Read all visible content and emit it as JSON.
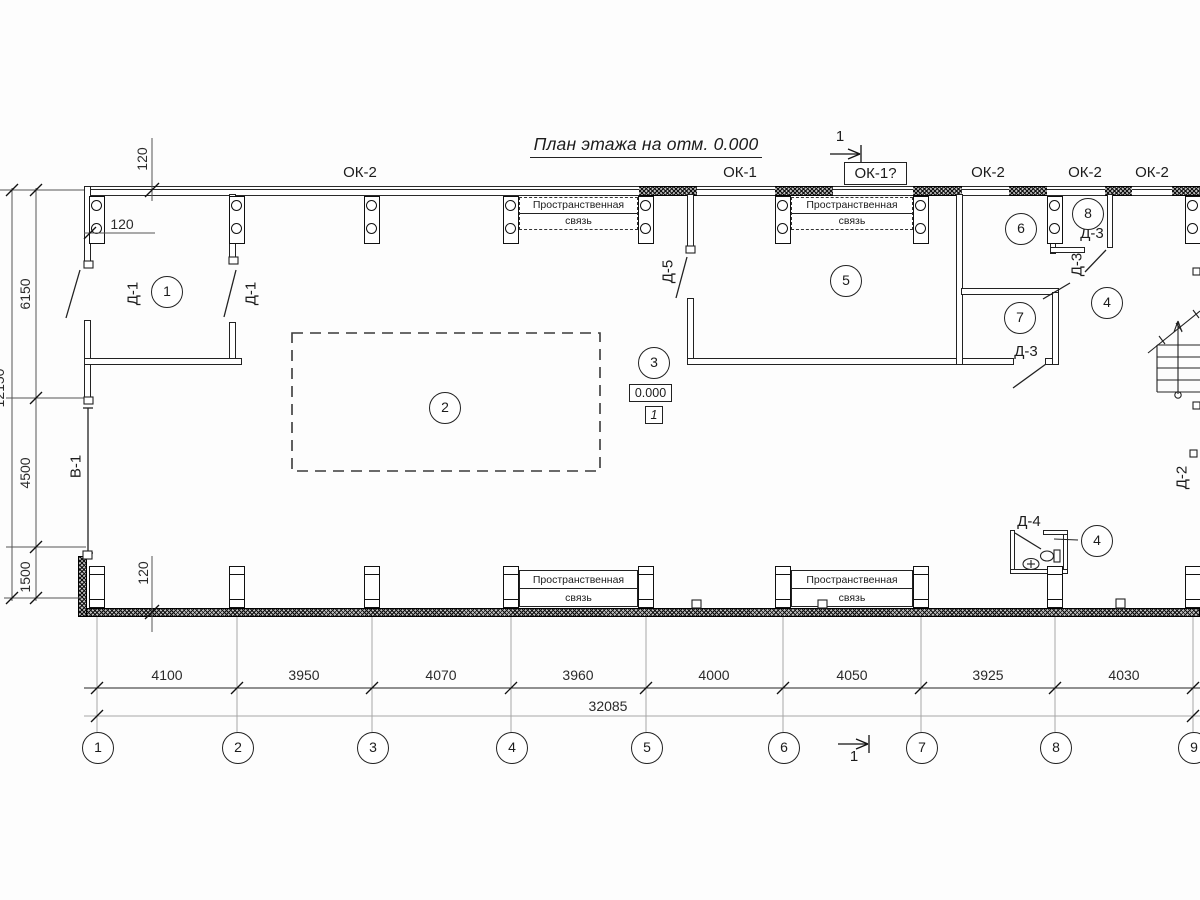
{
  "title": "План этажа на отм. 0.000",
  "section": {
    "label": "1"
  },
  "windows": {
    "ok2": "ОК-2",
    "ok1": "ОК-1",
    "ok1q": "ОК-1?"
  },
  "doors": {
    "d1": "Д-1",
    "d2": "Д-2",
    "d3": "Д-3",
    "d4": "Д-4",
    "d5": "Д-5"
  },
  "opening": {
    "v1": "В-1"
  },
  "rooms": {
    "r1": "1",
    "r2": "2",
    "r3": "3",
    "r4": "4",
    "r5": "5",
    "r6": "6",
    "r7": "7",
    "r8": "8"
  },
  "elevation": {
    "value": "0.000",
    "note": "1"
  },
  "brace": {
    "line1": "Пространственная",
    "line2": "связь"
  },
  "axes": [
    "1",
    "2",
    "3",
    "4",
    "5",
    "6",
    "7",
    "8",
    "9"
  ],
  "dims": {
    "bottom": [
      "4100",
      "3950",
      "4070",
      "3960",
      "4000",
      "4050",
      "3925",
      "4030"
    ],
    "total": "32085",
    "left": [
      "6150",
      "4500",
      "1500"
    ],
    "left_total": "12150",
    "offset": "120"
  },
  "colors": {
    "line": "#1c1c1c",
    "dim": "#555555",
    "grid": "#a6a6a6",
    "bg": "#fdfdfd"
  }
}
